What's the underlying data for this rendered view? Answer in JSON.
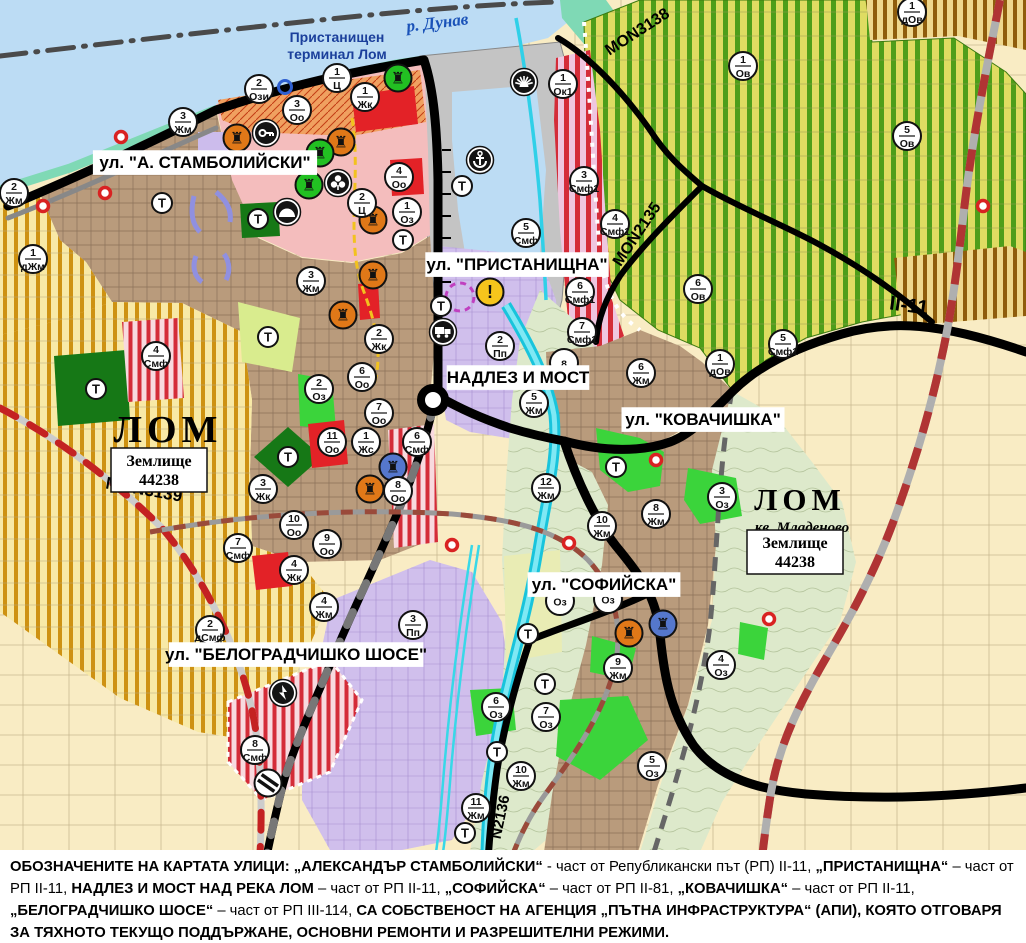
{
  "map": {
    "transformer_label": "Т",
    "colors": {
      "water": "#BCDCF4",
      "shore": "#7FD9B5",
      "port": "#C4C4C4",
      "vineyard": "#DFDC62",
      "urban_brown": "#B99B7C",
      "parcels_beige": "#F9ECC4",
      "industrial_purple": "#D0BFEC",
      "park_green": "#3BD43B",
      "park_dark": "#167816",
      "smf_red_stripe": "#D42C38",
      "road_black": "#000000",
      "rail_red": "#B03434",
      "mon3139_red": "#C42222",
      "river_cyan": "#18C4DC",
      "monument_orange": "#E07818",
      "monument_green": "#22C022",
      "monument_blue": "#5577CC",
      "warning_yellow": "#F6C51C"
    },
    "street_labels": [
      {
        "text": "ул. \"А. СТАМБОЛИЙСКИ\"",
        "x": 205,
        "y": 168,
        "fs": 17,
        "style": "box"
      },
      {
        "text": "ул. \"ПРИСТАНИЩНА\"",
        "x": 517,
        "y": 270,
        "fs": 17,
        "style": "box"
      },
      {
        "text": "НАДЛЕЗ И МОСТ",
        "x": 518,
        "y": 383,
        "fs": 17,
        "style": "box"
      },
      {
        "text": "ул. \"КОВАЧИШКА\"",
        "x": 703,
        "y": 425,
        "fs": 17,
        "style": "box"
      },
      {
        "text": "ул. \"СОФИЙСКА\"",
        "x": 604,
        "y": 590,
        "fs": 17,
        "style": "box"
      },
      {
        "text": "ул. \"БЕЛОГРАДЧИШКО ШОСЕ\"",
        "x": 296,
        "y": 660,
        "fs": 17,
        "style": "box"
      }
    ],
    "place_labels": [
      {
        "text": "р. Дунав",
        "x": 438,
        "y": 28,
        "fs": 17,
        "style": "water",
        "rot": -7
      },
      {
        "text": "Пристанищен",
        "x": 337,
        "y": 42,
        "fs": 14,
        "style": "port"
      },
      {
        "text": "терминал Лом",
        "x": 337,
        "y": 59,
        "fs": 14,
        "style": "port"
      },
      {
        "text": "ЛОМ",
        "x": 168,
        "y": 442,
        "fs": 38,
        "style": "city"
      },
      {
        "text": "ЛОМ",
        "x": 800,
        "y": 510,
        "fs": 31,
        "style": "city"
      },
      {
        "text": "кв. Младеново",
        "x": 802,
        "y": 532,
        "fs": 15,
        "style": "city-i"
      }
    ],
    "road_labels": [
      {
        "text": "MON3138",
        "x": 640,
        "y": 36,
        "fs": 16,
        "style": "road",
        "rot": -33
      },
      {
        "text": "MON2135",
        "x": 641,
        "y": 237,
        "fs": 16,
        "style": "road",
        "rot": -56
      },
      {
        "text": "MON3139",
        "x": 143,
        "y": 495,
        "fs": 17,
        "style": "road",
        "rot": 10
      },
      {
        "text": "N2136",
        "x": 505,
        "y": 818,
        "fs": 15,
        "style": "road",
        "rot": -78
      },
      {
        "text": "II-11",
        "x": 908,
        "y": 312,
        "fs": 20,
        "style": "road",
        "rot": 8
      }
    ],
    "landcode_boxes": [
      {
        "line1": "Землище",
        "line2": "44238",
        "x": 159,
        "y": 470
      },
      {
        "line1": "Землище",
        "line2": "44238",
        "x": 795,
        "y": 552
      }
    ],
    "zone_markers": [
      {
        "num": "2",
        "code": "Ози",
        "x": 259,
        "y": 89
      },
      {
        "num": "1",
        "code": "Ц",
        "x": 337,
        "y": 78
      },
      {
        "num": "3",
        "code": "Оо",
        "x": 297,
        "y": 110
      },
      {
        "num": "1",
        "code": "Жк",
        "x": 365,
        "y": 97
      },
      {
        "num": "3",
        "code": "Жм",
        "x": 183,
        "y": 122
      },
      {
        "num": "2",
        "code": "Жм",
        "x": 14,
        "y": 193
      },
      {
        "num": "1",
        "code": "дЖм",
        "x": 33,
        "y": 259
      },
      {
        "num": "4",
        "code": "Оо",
        "x": 399,
        "y": 177
      },
      {
        "num": "2",
        "code": "Ц",
        "x": 362,
        "y": 203
      },
      {
        "num": "1",
        "code": "Оз",
        "x": 407,
        "y": 212
      },
      {
        "num": "1",
        "code": "Ок1",
        "x": 563,
        "y": 84
      },
      {
        "num": "3",
        "code": "Смф1",
        "x": 584,
        "y": 181
      },
      {
        "num": "5",
        "code": "Смф",
        "x": 526,
        "y": 233
      },
      {
        "num": "4",
        "code": "Смф1",
        "x": 615,
        "y": 224
      },
      {
        "num": "1",
        "code": "Ов",
        "x": 743,
        "y": 66
      },
      {
        "num": "5",
        "code": "Ов",
        "x": 907,
        "y": 136
      },
      {
        "num": "1",
        "code": "дОв",
        "x": 912,
        "y": 12
      },
      {
        "num": "6",
        "code": "Ов",
        "x": 698,
        "y": 289
      },
      {
        "num": "1",
        "code": "дОв",
        "x": 720,
        "y": 364
      },
      {
        "num": "5",
        "code": "Смф1",
        "x": 783,
        "y": 344
      },
      {
        "num": "2",
        "code": "Жк",
        "x": 379,
        "y": 339
      },
      {
        "num": "3",
        "code": "Жм",
        "x": 311,
        "y": 281
      },
      {
        "num": "2",
        "code": "Оз",
        "x": 319,
        "y": 389
      },
      {
        "num": "6",
        "code": "Оо",
        "x": 362,
        "y": 377
      },
      {
        "num": "7",
        "code": "Оо",
        "x": 379,
        "y": 413
      },
      {
        "num": "11",
        "code": "Оо",
        "x": 332,
        "y": 442
      },
      {
        "num": "1",
        "code": "Жс",
        "x": 366,
        "y": 442
      },
      {
        "num": "6",
        "code": "Смф",
        "x": 417,
        "y": 442
      },
      {
        "num": "3",
        "code": "Жк",
        "x": 263,
        "y": 489
      },
      {
        "num": "8",
        "code": "Оо",
        "x": 398,
        "y": 491
      },
      {
        "num": "4",
        "code": "Смф",
        "x": 156,
        "y": 356
      },
      {
        "num": "10",
        "code": "Оо",
        "x": 294,
        "y": 525
      },
      {
        "num": "9",
        "code": "Оо",
        "x": 327,
        "y": 544
      },
      {
        "num": "7",
        "code": "Смф",
        "x": 238,
        "y": 548
      },
      {
        "num": "4",
        "code": "Жк",
        "x": 294,
        "y": 570
      },
      {
        "num": "4",
        "code": "Жм",
        "x": 324,
        "y": 607
      },
      {
        "num": "2",
        "code": "дСмф",
        "x": 210,
        "y": 630
      },
      {
        "num": "3",
        "code": "Пп",
        "x": 413,
        "y": 625
      },
      {
        "num": "8",
        "code": "Смф",
        "x": 255,
        "y": 750
      },
      {
        "num": "2",
        "code": "Пп",
        "x": 500,
        "y": 346
      },
      {
        "num": "6",
        "code": "Смф1",
        "x": 580,
        "y": 292
      },
      {
        "num": "7",
        "code": "Смф1",
        "x": 582,
        "y": 332
      },
      {
        "num": "8",
        "code": "",
        "x": 564,
        "y": 363
      },
      {
        "num": "5",
        "code": "Жм",
        "x": 534,
        "y": 403
      },
      {
        "num": "6",
        "code": "Жм",
        "x": 641,
        "y": 373
      },
      {
        "num": "12",
        "code": "Жм",
        "x": 546,
        "y": 488
      },
      {
        "num": "10",
        "code": "Жм",
        "x": 602,
        "y": 526
      },
      {
        "num": "8",
        "code": "Жм",
        "x": 656,
        "y": 514
      },
      {
        "num": "3",
        "code": "Оз",
        "x": 722,
        "y": 497
      },
      {
        "num": "9",
        "code": "Жм",
        "x": 618,
        "y": 668
      },
      {
        "num": "",
        "code": "Оз",
        "x": 560,
        "y": 601
      },
      {
        "num": "",
        "code": "Оз",
        "x": 608,
        "y": 599
      },
      {
        "num": "6",
        "code": "Оз",
        "x": 496,
        "y": 707
      },
      {
        "num": "7",
        "code": "Оз",
        "x": 546,
        "y": 717
      },
      {
        "num": "10",
        "code": "Жм",
        "x": 521,
        "y": 776
      },
      {
        "num": "11",
        "code": "Жм",
        "x": 476,
        "y": 808
      },
      {
        "num": "5",
        "code": "Оз",
        "x": 652,
        "y": 766
      },
      {
        "num": "4",
        "code": "Оз",
        "x": 721,
        "y": 665
      }
    ],
    "t_markers": [
      {
        "x": 162,
        "y": 203
      },
      {
        "x": 258,
        "y": 219
      },
      {
        "x": 441,
        "y": 306
      },
      {
        "x": 462,
        "y": 186
      },
      {
        "x": 403,
        "y": 240
      },
      {
        "x": 268,
        "y": 337
      },
      {
        "x": 288,
        "y": 457
      },
      {
        "x": 96,
        "y": 389
      },
      {
        "x": 616,
        "y": 467
      },
      {
        "x": 528,
        "y": 634
      },
      {
        "x": 545,
        "y": 684
      },
      {
        "x": 497,
        "y": 752
      },
      {
        "x": 465,
        "y": 833
      }
    ],
    "icons": [
      {
        "type": "culture",
        "color": "#E07818",
        "x": 237,
        "y": 138
      },
      {
        "type": "culture",
        "color": "#E07818",
        "x": 341,
        "y": 142
      },
      {
        "type": "culture",
        "color": "#E07818",
        "x": 373,
        "y": 220
      },
      {
        "type": "culture",
        "color": "#E07818",
        "x": 373,
        "y": 275
      },
      {
        "type": "culture",
        "color": "#E07818",
        "x": 343,
        "y": 315
      },
      {
        "type": "culture",
        "color": "#E07818",
        "x": 370,
        "y": 489
      },
      {
        "type": "culture",
        "color": "#E07818",
        "x": 629,
        "y": 633
      },
      {
        "type": "culture",
        "color": "#22C022",
        "x": 320,
        "y": 153
      },
      {
        "type": "culture",
        "color": "#22C022",
        "x": 309,
        "y": 185
      },
      {
        "type": "culture",
        "color": "#22C022",
        "x": 398,
        "y": 78
      },
      {
        "type": "culture",
        "color": "#5577CC",
        "x": 393,
        "y": 467
      },
      {
        "type": "culture",
        "color": "#5577CC",
        "x": 663,
        "y": 624
      },
      {
        "type": "key",
        "x": 266,
        "y": 133
      },
      {
        "type": "clover",
        "x": 338,
        "y": 183
      },
      {
        "type": "mountain",
        "x": 287,
        "y": 212
      },
      {
        "type": "anchor",
        "x": 480,
        "y": 160
      },
      {
        "type": "sun",
        "x": 524,
        "y": 82
      },
      {
        "type": "truck",
        "x": 443,
        "y": 332
      },
      {
        "type": "exclaim",
        "x": 490,
        "y": 292
      },
      {
        "type": "lightning",
        "x": 283,
        "y": 693
      },
      {
        "type": "railcross",
        "x": 268,
        "y": 783
      },
      {
        "type": "ring",
        "x": 285,
        "y": 87
      },
      {
        "type": "dashcircle",
        "x": 460,
        "y": 297
      }
    ],
    "red_dots": [
      {
        "x": 121,
        "y": 137
      },
      {
        "x": 105,
        "y": 193
      },
      {
        "x": 43,
        "y": 206
      },
      {
        "x": 656,
        "y": 460
      },
      {
        "x": 569,
        "y": 543
      },
      {
        "x": 769,
        "y": 619
      },
      {
        "x": 983,
        "y": 206
      },
      {
        "x": 452,
        "y": 545
      }
    ],
    "footer": {
      "segments": [
        {
          "t": "ОБОЗНАЧЕНИТЕ НА КАРТАТА УЛИЦИ: „АЛЕКСАНДЪР СТАМБОЛИЙСКИ“",
          "b": true
        },
        {
          "t": " - част от Републикански път (РП) II-11, ",
          "b": false
        },
        {
          "t": "„ПРИСТАНИЩНА“",
          "b": true
        },
        {
          "t": " – част от РП II-11, ",
          "b": false
        },
        {
          "t": "НАДЛЕЗ И МОСТ НАД РЕКА ЛОМ",
          "b": true
        },
        {
          "t": " – част от РП II-11, ",
          "b": false
        },
        {
          "t": "„СОФИЙСКА“",
          "b": true
        },
        {
          "t": " – част от РП II-81, ",
          "b": false
        },
        {
          "t": "„КОВАЧИШКА“",
          "b": true
        },
        {
          "t": " – част от РП II-11, ",
          "b": false
        },
        {
          "t": "„БЕЛОГРАДЧИШКО ШОСЕ“",
          "b": true
        },
        {
          "t": " – част от РП III-114, ",
          "b": false
        },
        {
          "t": "СА СОБСТВЕНОСТ НА АГЕНЦИЯ „ПЪТНА ИНФРАСТРУКТУРА“ (АПИ), КОЯТО ОТГОВАРЯ ЗА ТЯХНОТО ТЕКУЩО ПОДДЪРЖАНЕ, ОСНОВНИ РЕМОНТИ И РАЗРЕШИТЕЛНИ РЕЖИМИ.",
          "b": true
        }
      ]
    }
  }
}
